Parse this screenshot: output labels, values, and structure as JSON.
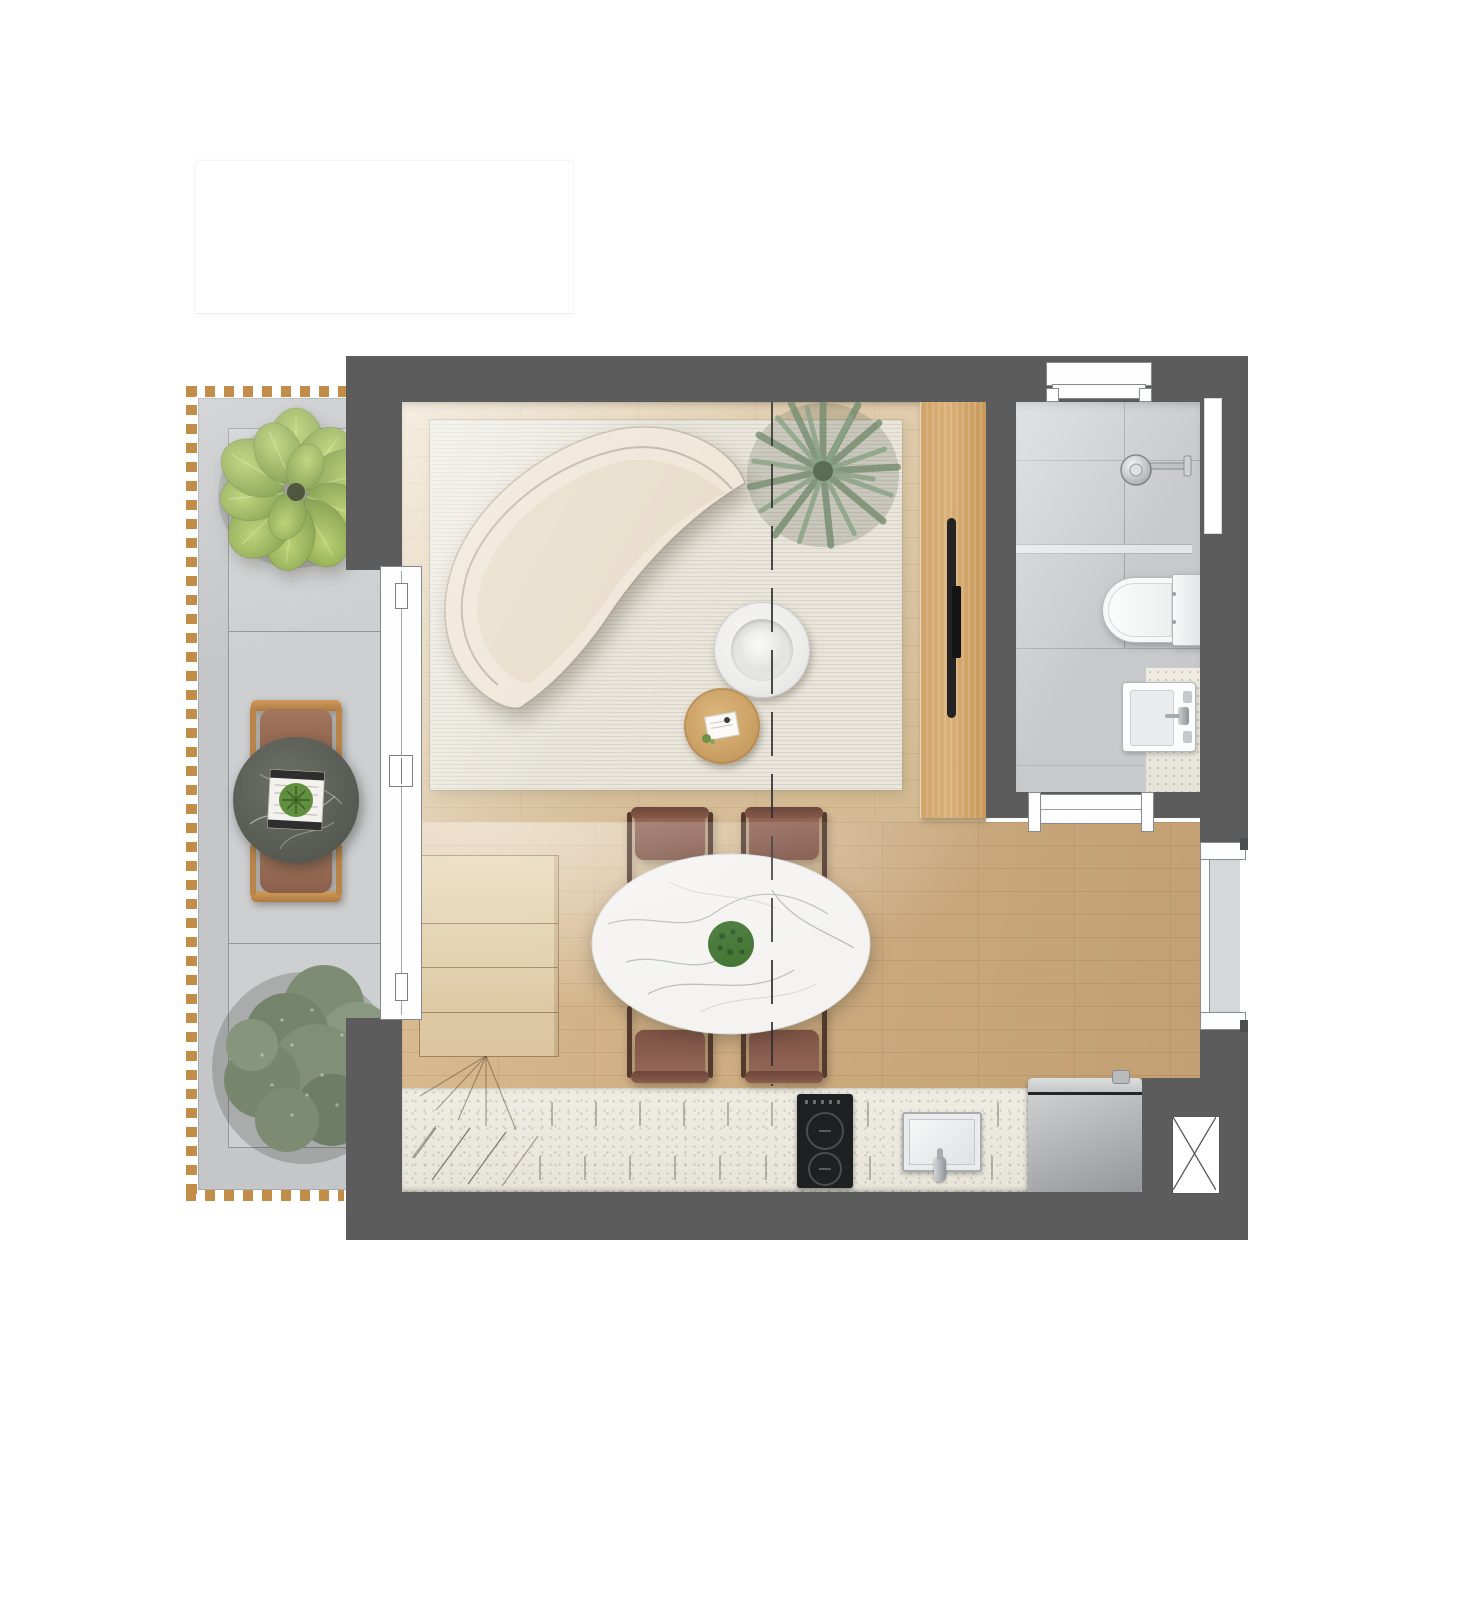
{
  "scene": {
    "type": "apartment-floor-plan-rendering",
    "rooms": [
      "balcony",
      "living-area",
      "dining-area",
      "kitchen",
      "bathroom"
    ],
    "furniture": [
      "curved-sofa",
      "area-rug",
      "marble-coffee-table",
      "wood-coffee-table",
      "oval-dining-table",
      "dining-chairs",
      "sideboard-cabinet",
      "wardrobe-panel",
      "kitchen-counter",
      "induction-cooktop",
      "kitchen-sink",
      "refrigerator",
      "bistro-table",
      "bistro-chairs",
      "toilet",
      "shower",
      "vanity-sink",
      "potted-plants"
    ]
  },
  "palette": {
    "background": "#ffffff",
    "wall": "#5c5c5c",
    "balcony_floor": "#c4c6c8",
    "balcony_panel": "#cdcfd1",
    "deck_dash": "#c28c49",
    "wood_light_a": "#e6d5b8",
    "wood_light_b": "#d9c19c",
    "wood_warm_a": "#d9bb90",
    "wood_warm_b": "#c9a87c",
    "rug": "#e9e5da",
    "sofa": "#efe6d7",
    "counter": "#e7e4da",
    "tile": "#c7c9cb",
    "wardrobe_a": "#d0a266",
    "wardrobe_b": "#c89a5b",
    "chair": "#7e5344",
    "chair_dark": "#6b463a",
    "leaf_green": "#9cb84e",
    "fern_green": "#7e967b",
    "sage_green": "#7e8d74",
    "marble_white": "#f4f3f1",
    "marble_dark": "#5e615a",
    "fridge_b": "#95979b",
    "cooktop": "#1e2021"
  }
}
